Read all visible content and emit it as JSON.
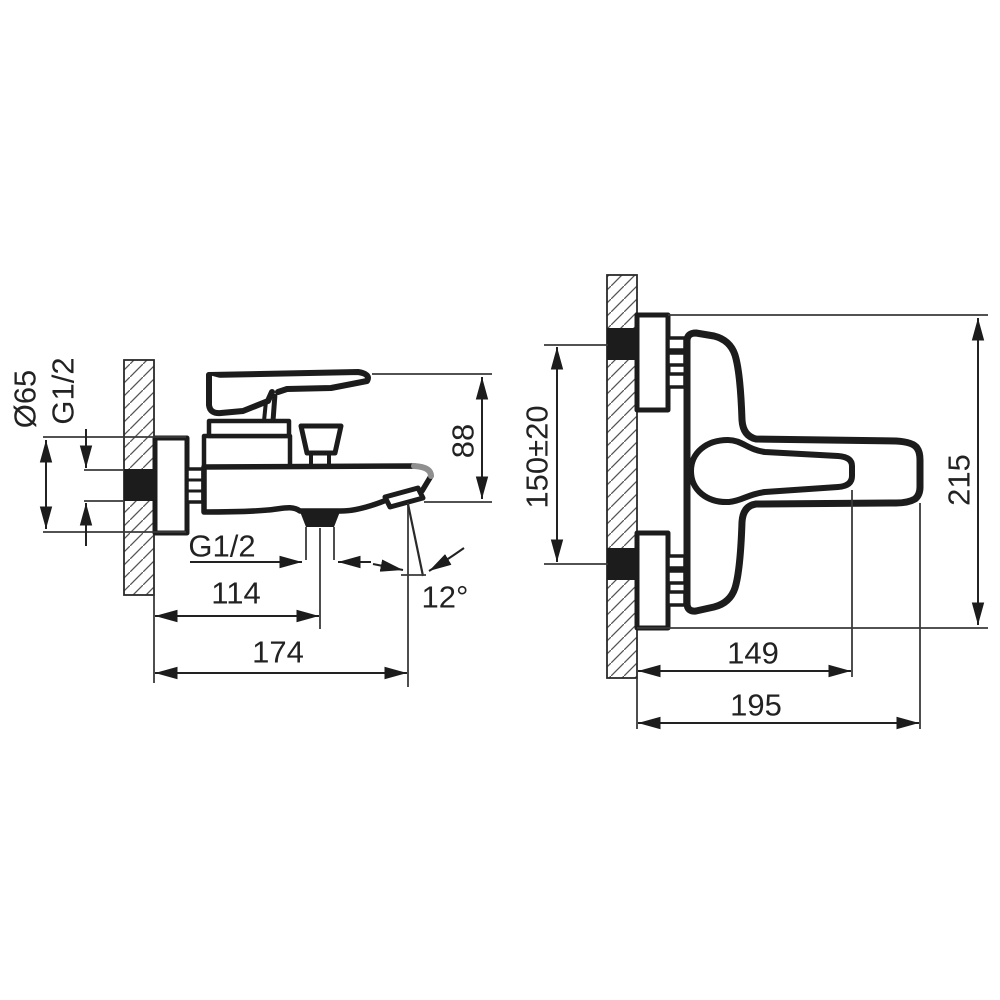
{
  "page": {
    "background": "#ffffff",
    "line_color": "#1c1c1c",
    "text_color": "#222222"
  },
  "drawing": {
    "title": "wall-mounted bath mixer tap dimensional drawing",
    "side_view": {
      "dim_flange_diameter": "Ø65",
      "dim_inlet_thread": "G1/2",
      "dim_spout_drop_height": "88",
      "dim_outlet_thread": "G1/2",
      "dim_wall_to_outlet_axis": "114",
      "dim_wall_to_spout_tip": "174",
      "dim_spout_angle": "12°"
    },
    "front_view": {
      "dim_connection_spacing": "150±20",
      "dim_overall_height": "215",
      "dim_wall_to_lever_end": "149",
      "dim_overall_reach": "195"
    }
  }
}
